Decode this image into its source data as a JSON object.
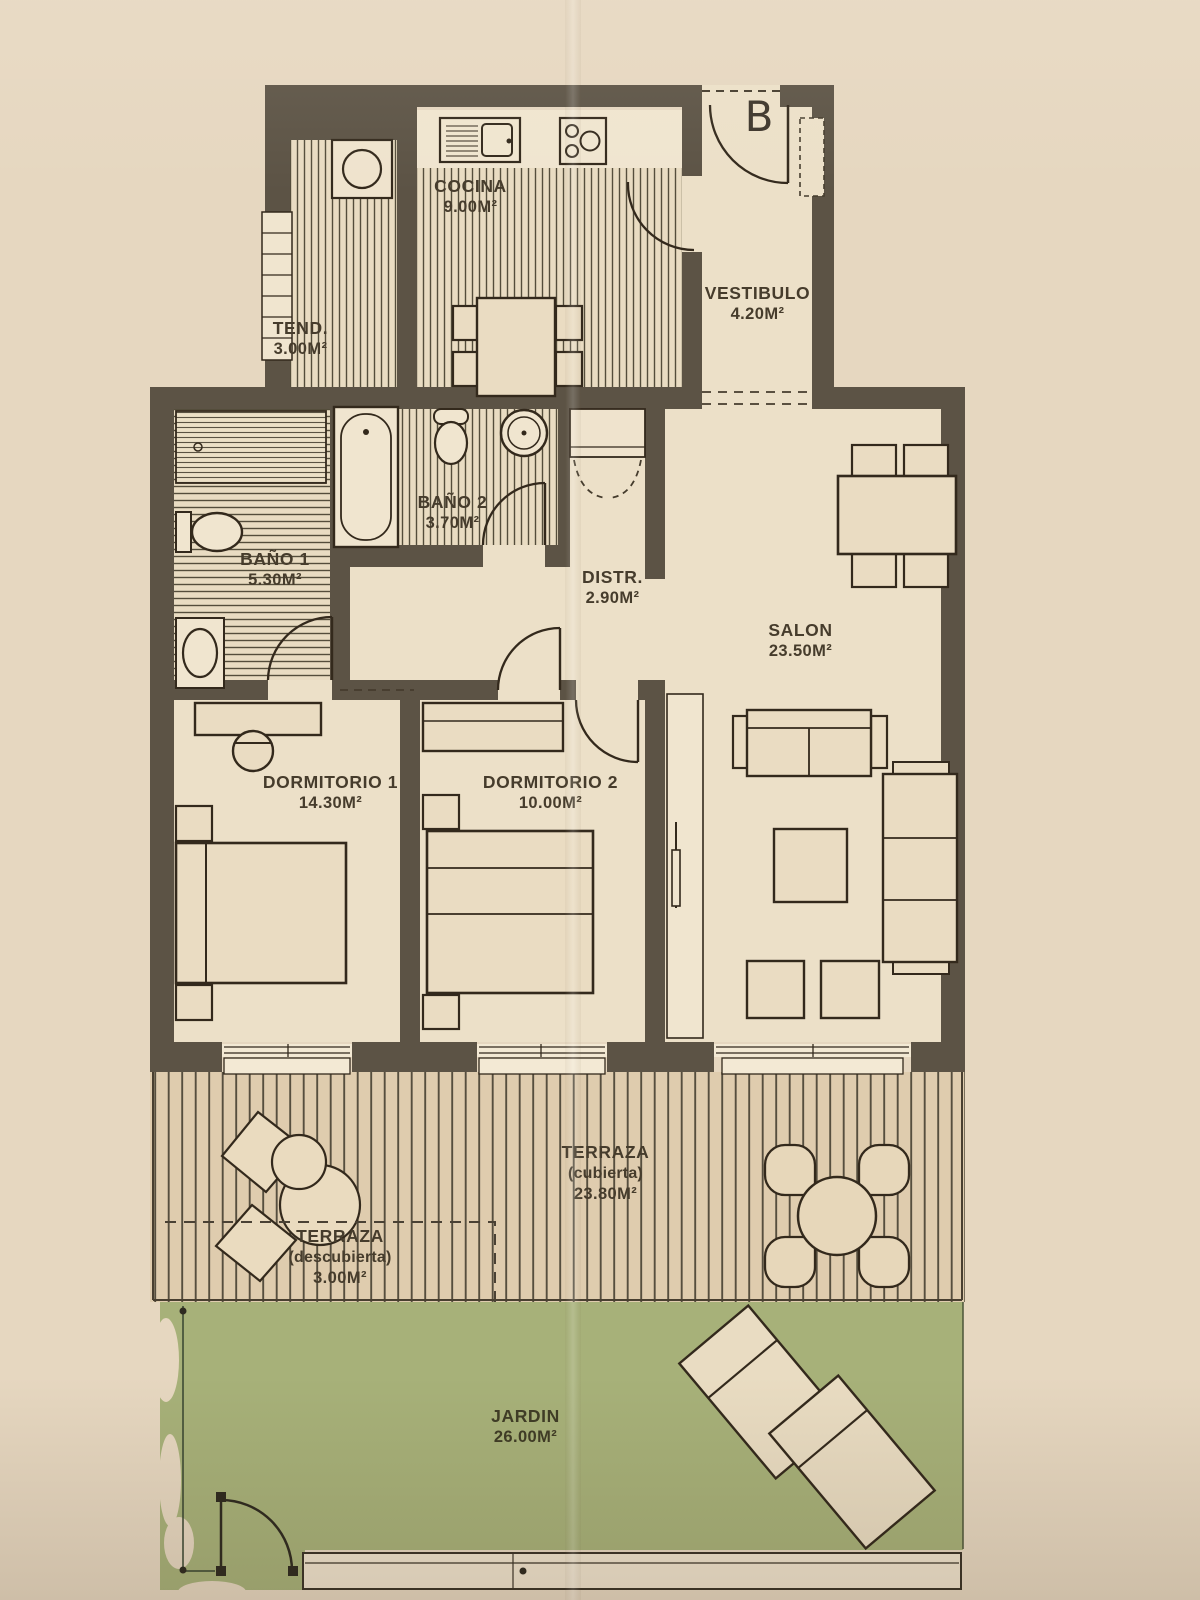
{
  "plan": {
    "title": "apartment-floor-plan",
    "entrance_label": "B",
    "rooms": [
      {
        "key": "cocina",
        "label": "COCINA",
        "area": "9.00m²"
      },
      {
        "key": "tendedero",
        "label": "TEND.",
        "area": "3.00m²"
      },
      {
        "key": "vestibulo",
        "label": "VESTIBULO",
        "area": "4.20m²"
      },
      {
        "key": "bano1",
        "label": "BAÑO 1",
        "area": "5.30m²"
      },
      {
        "key": "bano2",
        "label": "BAÑO 2",
        "area": "3.70m²"
      },
      {
        "key": "distribuidor",
        "label": "DISTR.",
        "area": "2.90m²"
      },
      {
        "key": "salon",
        "label": "SALON",
        "area": "23.50m²"
      },
      {
        "key": "dormitorio1",
        "label": "DORMITORIO 1",
        "area": "14.30m²"
      },
      {
        "key": "dormitorio2",
        "label": "DORMITORIO 2",
        "area": "10.00m²"
      },
      {
        "key": "terraza_cubierta",
        "label": "TERRAZA",
        "sublabel": "(cubierta)",
        "area": "23.80m²"
      },
      {
        "key": "terraza_descubierta",
        "label": "TERRAZA",
        "sublabel": "(descubierta)",
        "area": "3.00m²"
      },
      {
        "key": "jardin",
        "label": "JARDIN",
        "area": "26.00m²"
      }
    ],
    "colors": {
      "paper": "#e6d7c0",
      "wall": "#5c5345",
      "floor": "#ece0c8",
      "stripe": "#544d3b",
      "terrace": "#dfccae",
      "garden_green": "#a7b179",
      "line": "#33291c"
    }
  }
}
